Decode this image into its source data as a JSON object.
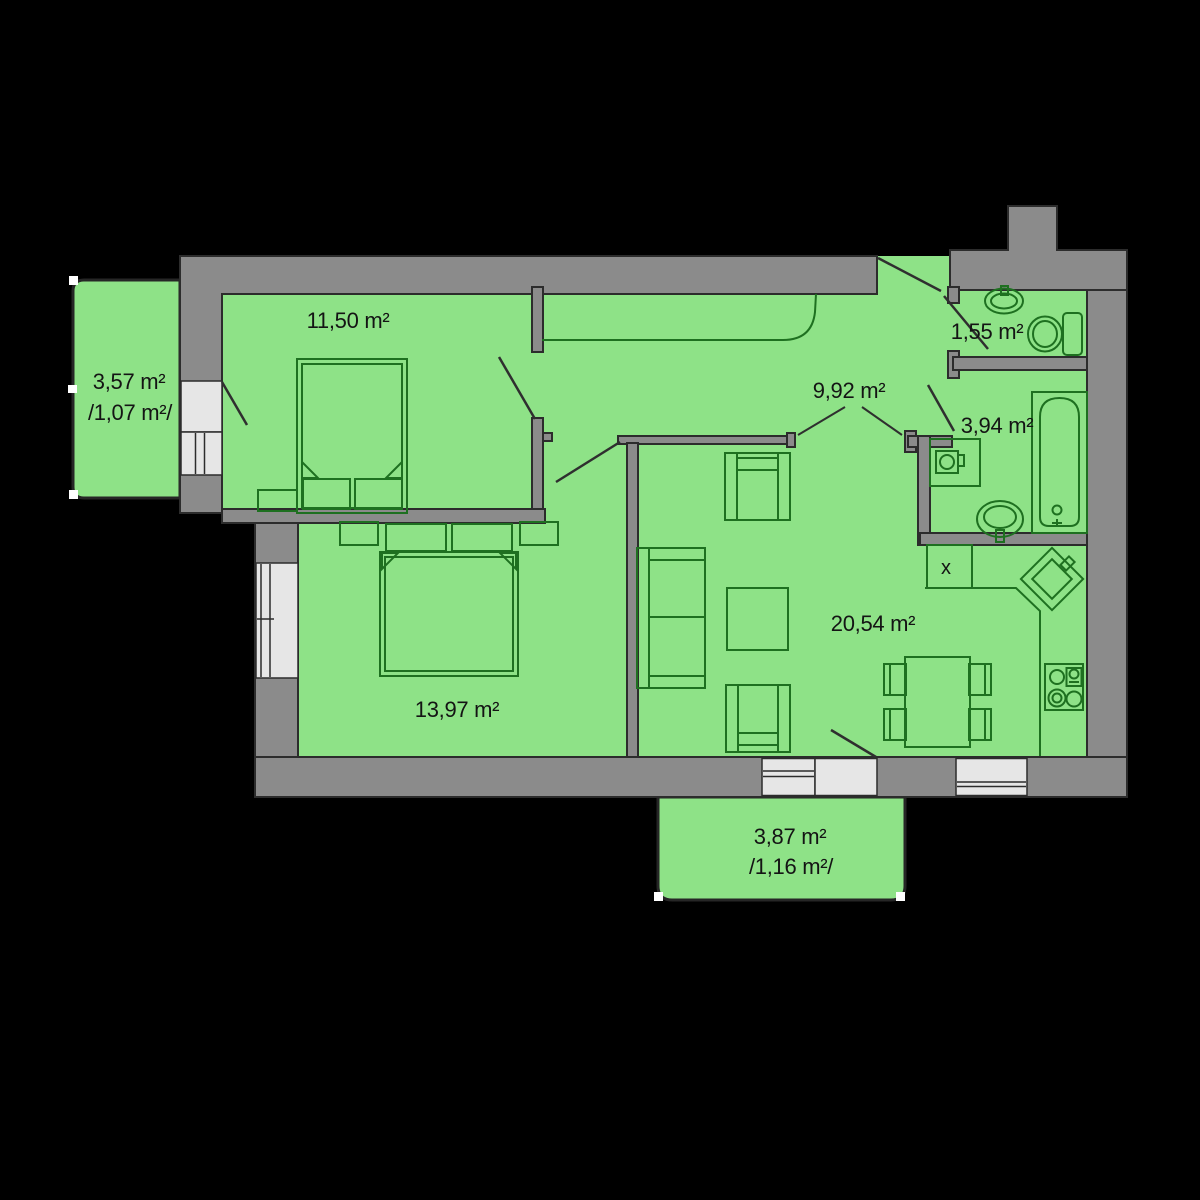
{
  "plan": {
    "background": "#000000",
    "colors": {
      "room_fill": "#8EE287",
      "wall_fill": "#8B8B8B",
      "wall_line": "#2C2C2C",
      "furniture_line": "#1E7020",
      "opening_fill": "#E6E6E6",
      "label_color": "#141414"
    },
    "rooms": [
      {
        "id": "bedroom-1",
        "area": "11,50 m²"
      },
      {
        "id": "balcony-left",
        "area": "3,57 m²",
        "area_secondary": "/1,07 m²/"
      },
      {
        "id": "hallway",
        "area": "9,92 m²"
      },
      {
        "id": "wc",
        "area": "1,55 m²"
      },
      {
        "id": "bathroom",
        "area": "3,94 m²"
      },
      {
        "id": "living-room-kitchen",
        "area": "20,54 m²"
      },
      {
        "id": "bedroom-2",
        "area": "13,97 m²"
      },
      {
        "id": "balcony-bottom",
        "area": "3,87 m²",
        "area_secondary": "/1,16 m²/"
      }
    ],
    "symbols": {
      "ventilation_shaft_label": "x"
    }
  }
}
